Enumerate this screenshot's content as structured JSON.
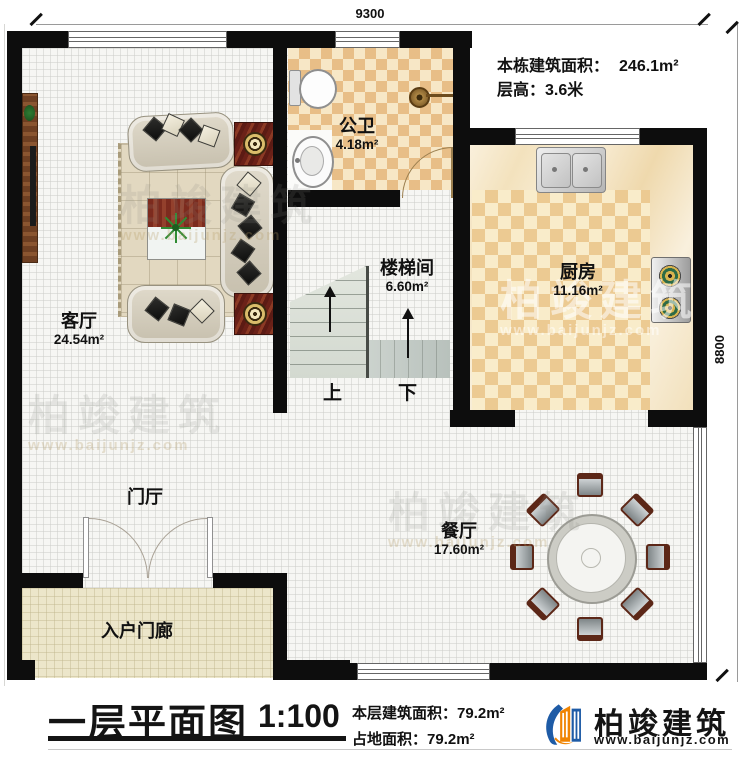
{
  "dimensions": {
    "top": "9300",
    "right": "8800"
  },
  "info": {
    "building_area_label": "本栋建筑面积：",
    "building_area_value": "246.1m²",
    "floor_height_label": "层高：",
    "floor_height_value": "3.6米"
  },
  "rooms": [
    {
      "id": "living",
      "name": "客厅",
      "area": "24.54m²"
    },
    {
      "id": "bath",
      "name": "公卫",
      "area": "4.18m²"
    },
    {
      "id": "stair",
      "name": "楼梯间",
      "area": "6.60m²"
    },
    {
      "id": "kitchen",
      "name": "厨房",
      "area": "11.16m²"
    },
    {
      "id": "dining",
      "name": "餐厅",
      "area": "17.60m²"
    },
    {
      "id": "foyer",
      "name": "门厅",
      "area": ""
    },
    {
      "id": "porch",
      "name": "入户门廊",
      "area": ""
    }
  ],
  "stairs": {
    "up": "上",
    "down": "下"
  },
  "watermark": {
    "brand": "柏竣建筑",
    "website": "www.baijunjz.com"
  },
  "footer": {
    "plan_title": "一层平面图",
    "scale": "1:100",
    "floor_area_label": "本层建筑面积：",
    "floor_area_value": "79.2m²",
    "land_area_label": "占地面积：",
    "land_area_value": "79.2m²",
    "brand": "柏竣建筑",
    "website": "www.baijunjz.com"
  }
}
